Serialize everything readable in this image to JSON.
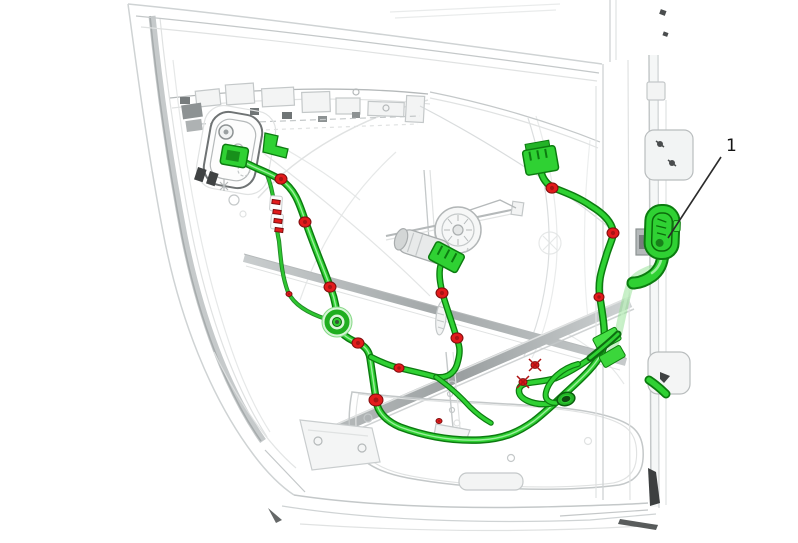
{
  "figure": {
    "kind": "service-manual-illustration",
    "subject": "Rear side door inner view with wiring harness highlighted",
    "callout": {
      "label": "1",
      "label_x": 726,
      "label_y": 151,
      "target": "door-harness-pass-through-connector",
      "leader": {
        "x1": 721,
        "y1": 157,
        "x2": 668,
        "y2": 238
      }
    },
    "colors": {
      "harness_green": "#2fd133",
      "harness_outline": "#0c7c10",
      "harness_sheen": "#a9f2a9",
      "harness_light": "#8fe08f",
      "clip_red": "#e31b1c",
      "callout_text": "#141414",
      "leader_color": "#2b2b2b",
      "panel_gray": "#cfd3d4"
    },
    "grommet": {
      "cx": 337,
      "cy": 322
    },
    "fasteners": [
      {
        "x": 281,
        "y": 179,
        "r": 6,
        "type": "dot"
      },
      {
        "x": 305,
        "y": 222,
        "r": 6,
        "type": "dot"
      },
      {
        "x": 330,
        "y": 287,
        "r": 6,
        "type": "dot"
      },
      {
        "x": 358,
        "y": 343,
        "r": 6,
        "type": "dot"
      },
      {
        "x": 399,
        "y": 368,
        "r": 5,
        "type": "dot"
      },
      {
        "x": 376,
        "y": 400,
        "r": 7,
        "type": "dot"
      },
      {
        "x": 442,
        "y": 293,
        "r": 6,
        "type": "dot"
      },
      {
        "x": 457,
        "y": 338,
        "r": 6,
        "type": "dot"
      },
      {
        "x": 552,
        "y": 188,
        "r": 6,
        "type": "dot"
      },
      {
        "x": 613,
        "y": 233,
        "r": 6,
        "type": "dot"
      },
      {
        "x": 599,
        "y": 297,
        "r": 5,
        "type": "dot"
      },
      {
        "x": 535,
        "y": 365,
        "r": 4,
        "type": "x"
      },
      {
        "x": 523,
        "y": 382,
        "r": 4,
        "type": "x"
      },
      {
        "x": 439,
        "y": 421,
        "r": 3,
        "type": "dot"
      },
      {
        "x": 289,
        "y": 294,
        "r": 3,
        "type": "dot"
      },
      {
        "x": 276,
        "y": 202,
        "r": 4,
        "type": "tick"
      },
      {
        "x": 277,
        "y": 212,
        "r": 4,
        "type": "tick"
      },
      {
        "x": 278,
        "y": 221,
        "r": 4,
        "type": "tick"
      },
      {
        "x": 279,
        "y": 230,
        "r": 4,
        "type": "tick"
      }
    ]
  }
}
